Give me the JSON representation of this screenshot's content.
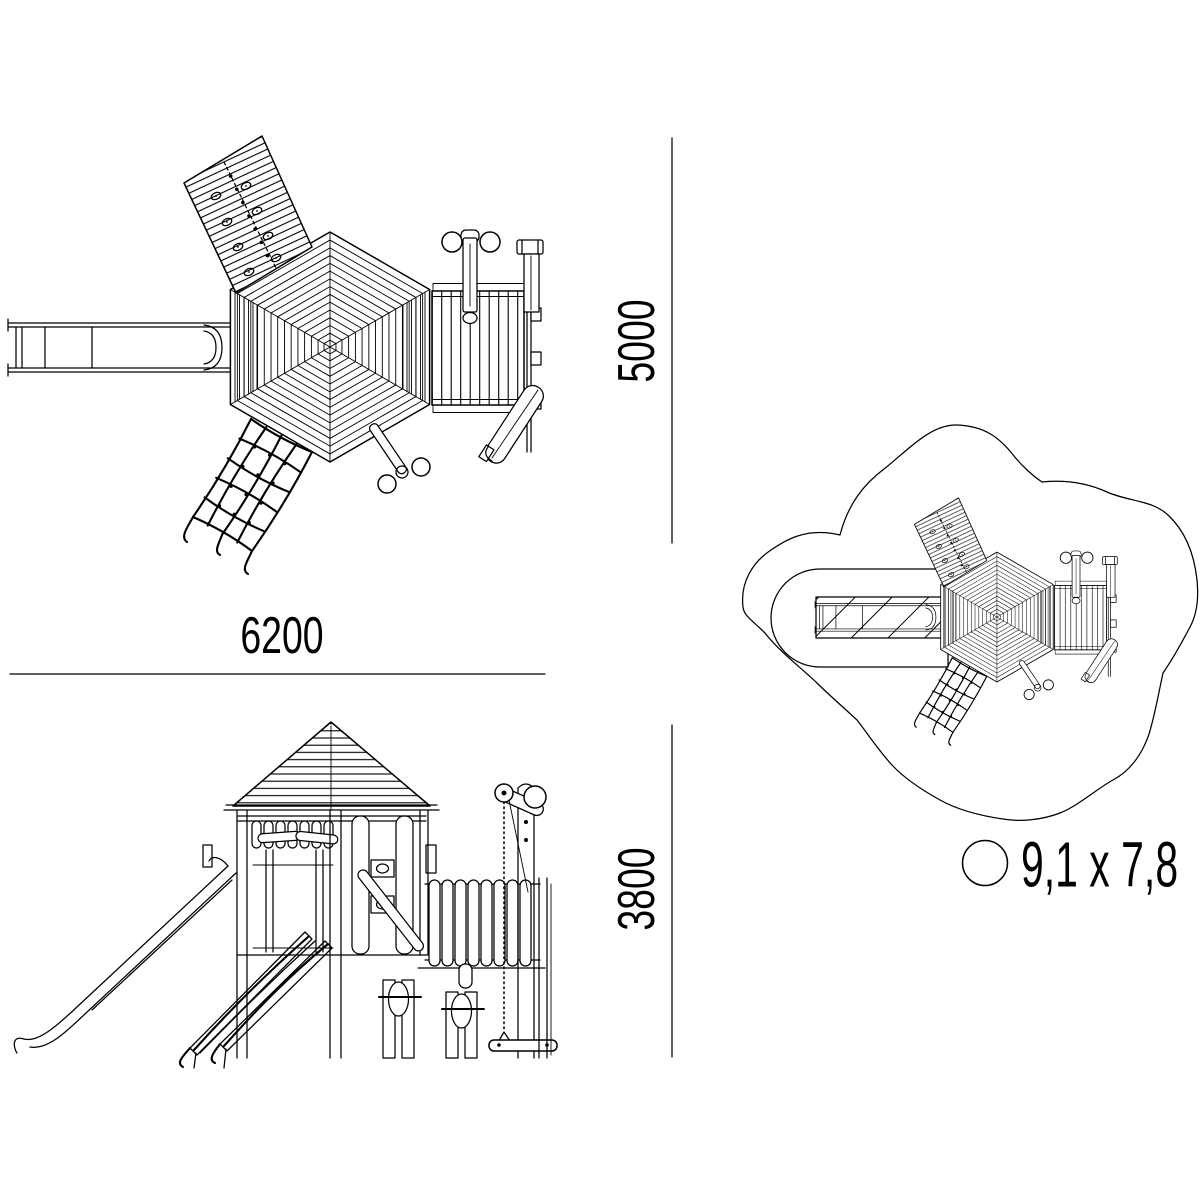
{
  "page": {
    "background": "#ffffff",
    "line_color": "#000000"
  },
  "dimensions": {
    "top_width": {
      "value": "6200"
    },
    "top_depth": {
      "value": "5000"
    },
    "front_height": {
      "value": "3800"
    }
  },
  "footprint": {
    "symbol": "circle-icon",
    "label": "9,1 x 7,8"
  }
}
